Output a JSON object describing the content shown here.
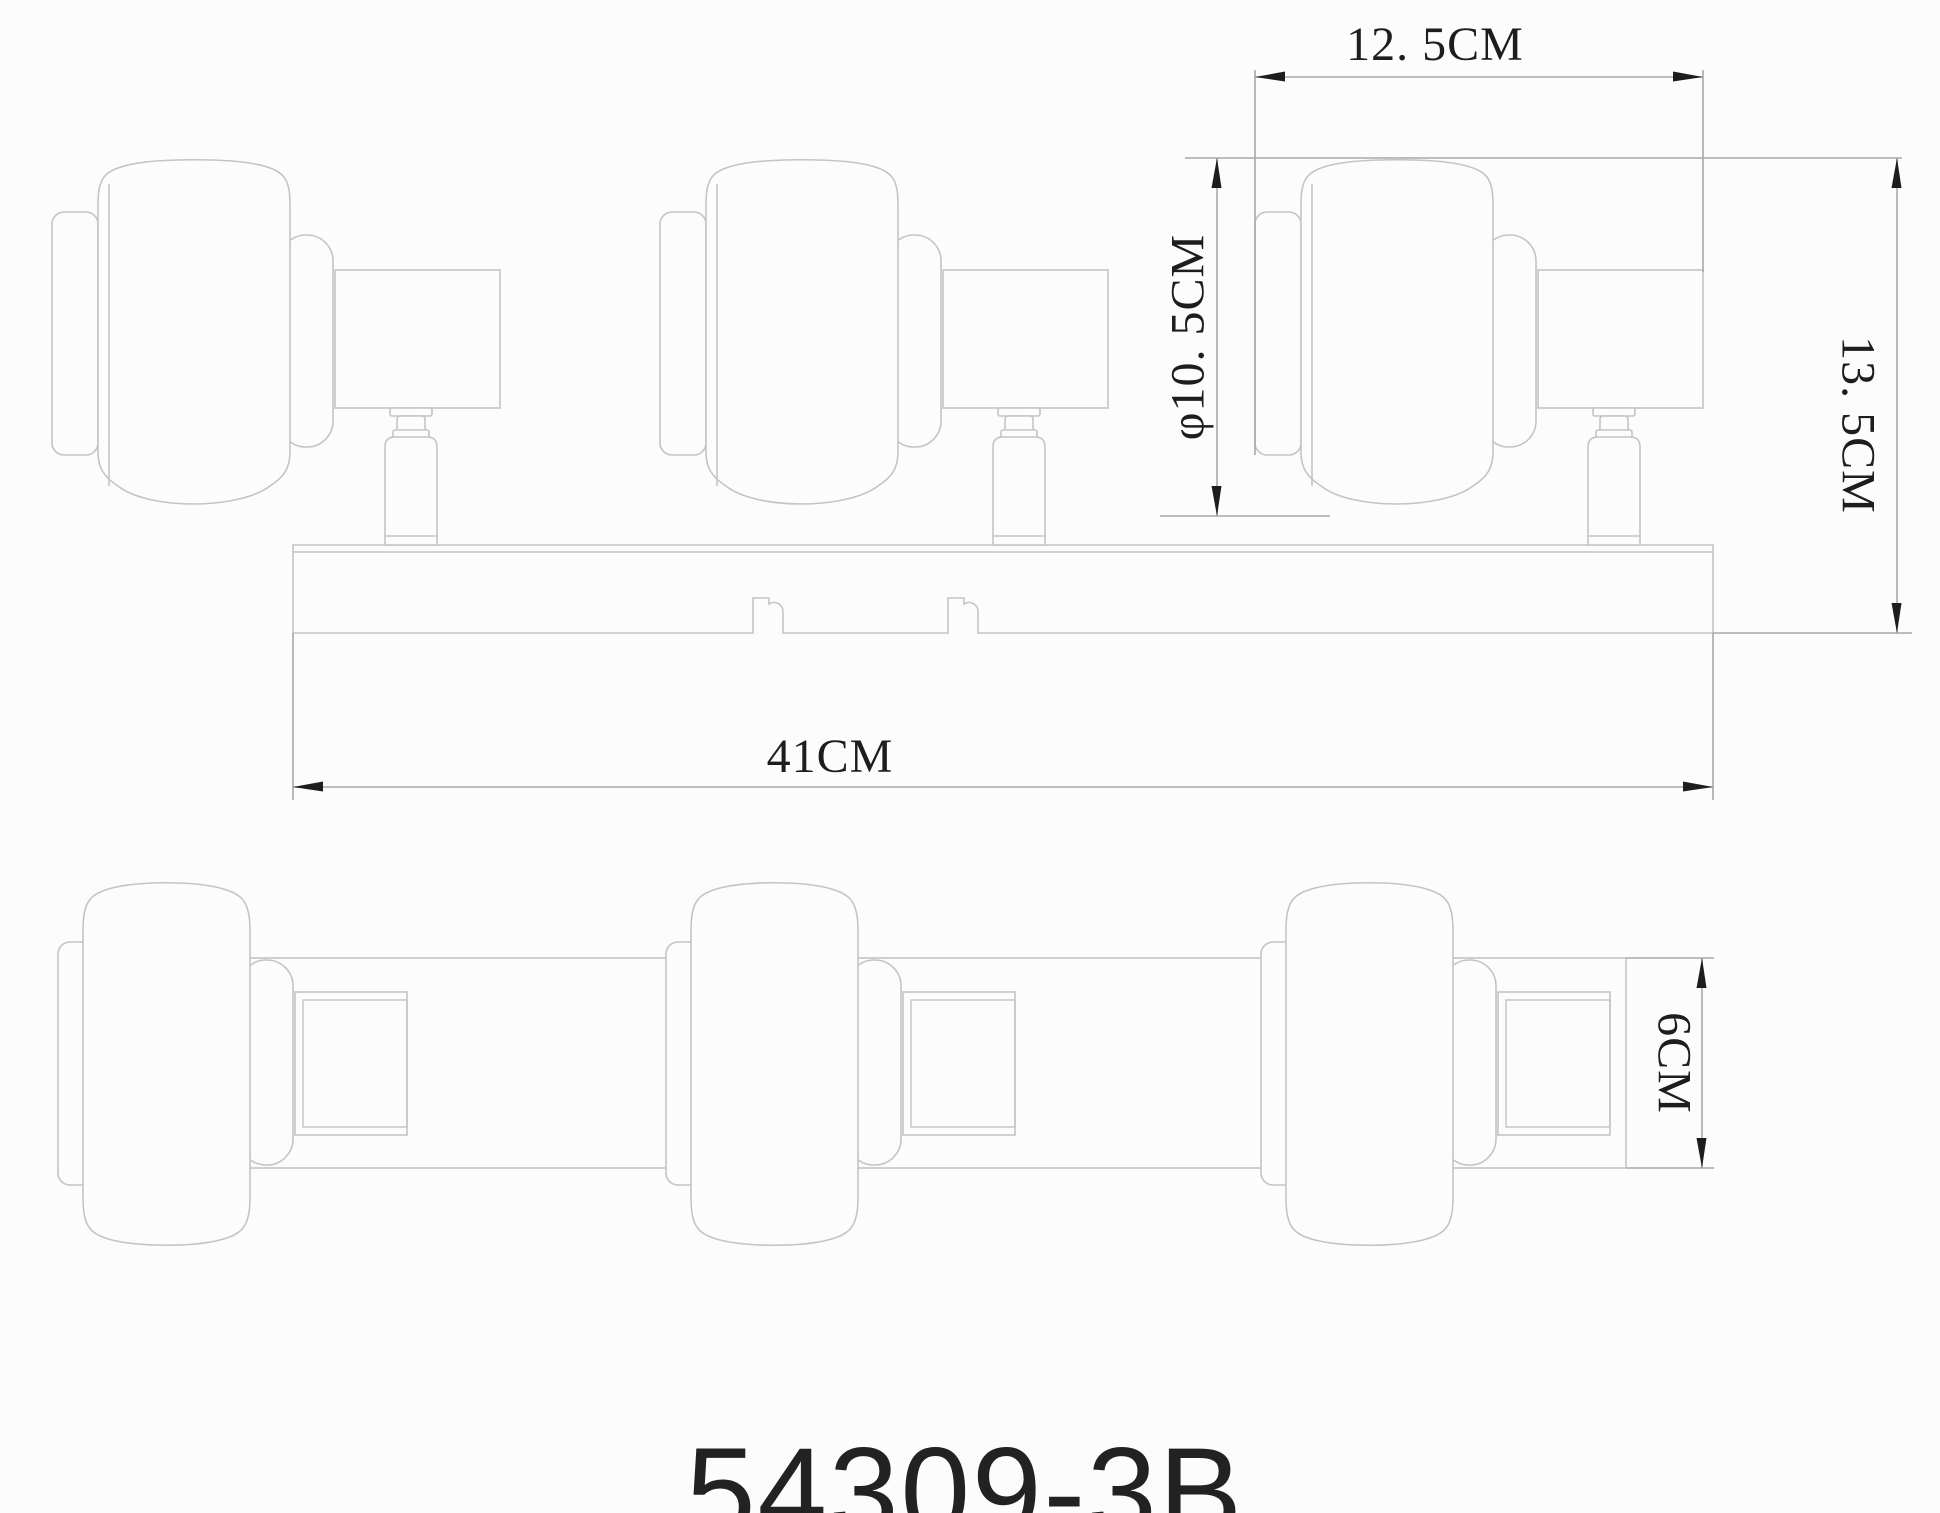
{
  "page": {
    "width": 1940,
    "height": 1513,
    "background": "#fcfcfc"
  },
  "labels": {
    "dim_unit_width": "12. 5CM",
    "dim_shade_diameter": "φ10. 5CM",
    "dim_fixture_height": "13. 5CM",
    "dim_bar_length": "41CM",
    "dim_bar_depth": "6CM",
    "model_number": "54309-3B"
  },
  "colors": {
    "line": "#c4c4c4",
    "dim_line": "#a8a8a8",
    "ink": "#1d1d1d",
    "fill": "#fcfcfc"
  },
  "drawing": {
    "top_view": {
      "bar": {
        "x1": 293,
        "x2": 1713,
        "top": 545,
        "bottom": 633,
        "inner_top": 552,
        "keyhole_x": [
          753,
          948
        ]
      },
      "unit_x": [
        52,
        660,
        1255
      ]
    },
    "bottom_view": {
      "bar": {
        "x1": 203,
        "x2": 1626,
        "top": 958,
        "bottom": 1168
      },
      "unit_x": [
        52,
        660,
        1255
      ]
    },
    "dimensions": {
      "unit_width": {
        "y": 77,
        "x1": 1255,
        "x2": 1703,
        "ext1": [
          1255,
          70,
          1255,
          455
        ],
        "ext2": [
          1703,
          70,
          1703,
          272
        ]
      },
      "shade_diameter": {
        "x": 1217,
        "y1": 158,
        "y2": 516,
        "ext_top": [
          1185,
          158,
          1902,
          158
        ],
        "ext_bottom": [
          1160,
          516,
          1330,
          516
        ]
      },
      "fixture_height": {
        "x": 1897,
        "y1": 158,
        "y2": 633,
        "ext_bottom": [
          1713,
          633,
          1912,
          633
        ]
      },
      "bar_length": {
        "y": 787,
        "x1": 293,
        "x2": 1713,
        "ext1": [
          293,
          633,
          293,
          800
        ],
        "ext2": [
          1713,
          633,
          1713,
          800
        ]
      },
      "bar_depth": {
        "x": 1702,
        "y1": 958,
        "y2": 1168,
        "ext_top": [
          1626,
          958,
          1714,
          958
        ],
        "ext_bottom": [
          1626,
          1168,
          1714,
          1168
        ]
      }
    }
  }
}
